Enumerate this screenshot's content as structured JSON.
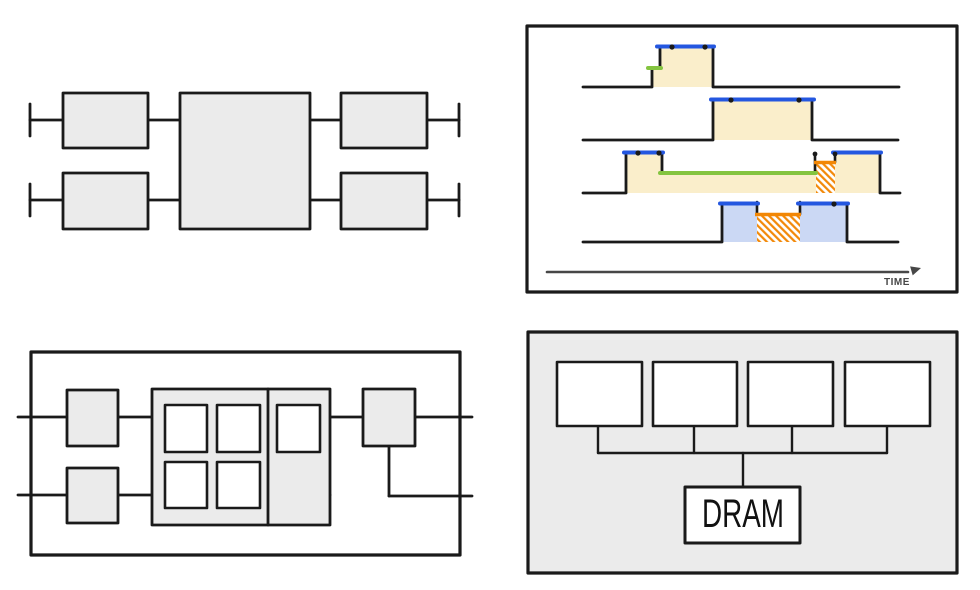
{
  "timeline": {
    "axis_label": "TIME"
  },
  "dram_tree": {
    "dram_label": "DRAM"
  },
  "colors": {
    "ink": "#1a1a1a",
    "white": "#ffffff",
    "tan": "#faeecb",
    "blue": "#2457e0",
    "green": "#84c440",
    "orange": "#f28705",
    "lightblue": "#cbd8f4",
    "boxgray": "#ebebeb",
    "panelgray": "#ebebeb",
    "axisgray": "#474747"
  }
}
